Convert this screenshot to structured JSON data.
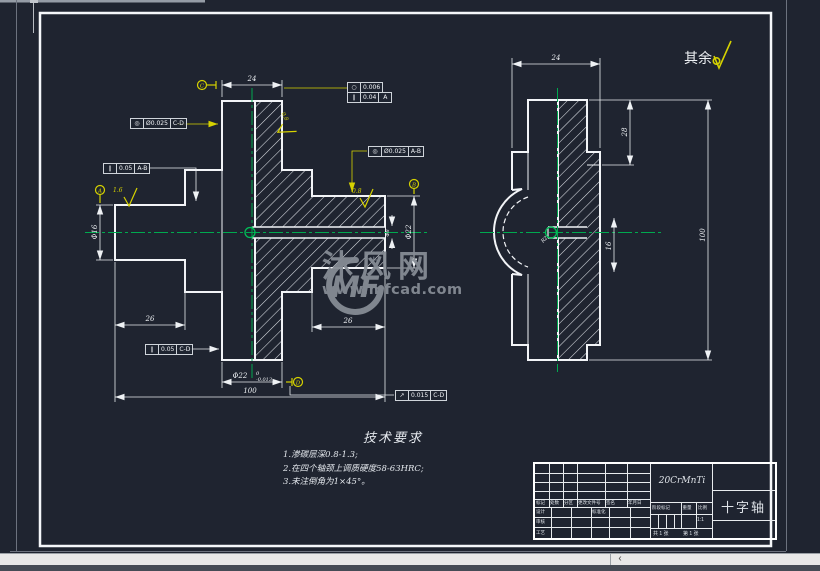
{
  "app": {
    "scroll_left_arrow": "‹"
  },
  "sheet": {
    "others_label": "其余",
    "tech_req": {
      "title": "技术要求",
      "items": [
        "1.渗碳层深0.8-1.3;",
        "2.在四个轴颈上调质硬度58-63HRC;",
        "3.未注倒角为1×45°。"
      ]
    },
    "watermark": {
      "logo": "MF",
      "plus": "+",
      "name": "沐风网",
      "url": "www.mfcad.com"
    }
  },
  "frames": {
    "circularity": {
      "sym": "○",
      "val": "0.006"
    },
    "parallel_a": {
      "sym": "∥",
      "val": "0.04",
      "datum": "A"
    },
    "concentric_cd": {
      "sym": "◎",
      "val": "Ø0.025",
      "datum": "C-D"
    },
    "parallel_ab": {
      "sym": "∥",
      "val": "0.05",
      "datum": "A-B"
    },
    "concentric_ab": {
      "sym": "◎",
      "val": "Ø0.025",
      "datum": "A-B"
    },
    "parallel_cd": {
      "sym": "∥",
      "val": "0.05",
      "datum": "C-D"
    },
    "runout_cd": {
      "sym": "↗",
      "val": "0.015",
      "datum": "C-D"
    }
  },
  "datums": {
    "a": "A",
    "b": "B",
    "c": "C",
    "d": "D"
  },
  "dims": {
    "front_top_width": "24",
    "front_left_journal_len": "26",
    "front_right_journal_len": "26",
    "front_total_len": "100",
    "front_bottom_dia": "Φ22",
    "front_bottom_tol_upper": "0",
    "front_bottom_tol_lower": "-0.013",
    "front_left_dia": "Φ16",
    "front_right_dia": "Φ22",
    "front_hole_dia": "Φ8",
    "side_width": "24",
    "side_upper_len": "28",
    "side_total_len": "100",
    "side_hole_depth": "16",
    "side_radius": "R2",
    "rough_left": "1.6",
    "rough_hub": "0.8",
    "rough_right": "0.8"
  },
  "title_block": {
    "material": "20CrMnTi",
    "part_name": "十字轴",
    "rev_labels": [
      "标记",
      "处数",
      "分区",
      "更改文件号",
      "签名",
      "年月日"
    ],
    "design": "设计",
    "standard": "标准化",
    "check": "审核",
    "process": "工艺",
    "stage": "阶段标记",
    "weight": "重量",
    "scale": "比例",
    "scale_value": "1:1",
    "sheet_total": "共 1 张",
    "sheet_no": "第 1 张"
  }
}
